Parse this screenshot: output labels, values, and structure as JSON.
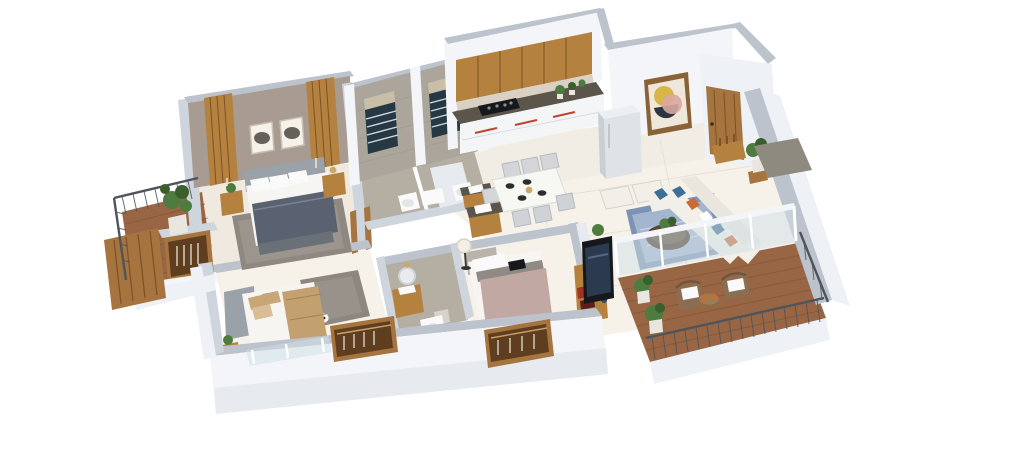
{
  "scene": {
    "title": "3D Isometric Apartment Floor Plan Render",
    "description": "Photorealistic isometric cutaway 3D floor plan of a 3-bedroom apartment on a white background: master bedroom with balcony, two tiled bathrooms, open kitchen with dining, entrance foyer, living room with L-shaped sofa, large wooden terrace, two additional bedrooms with wardrobes and a common bathroom.",
    "background": "#ffffff",
    "view": "isometric-top-down-3d",
    "visible_text": []
  },
  "palette": {
    "bg": "#ffffff",
    "wallCap": "#bcc3cc",
    "wallCapLight": "#cfd5dd",
    "wallFace": "#f3f5f8",
    "wallShade": "#e7ebf0",
    "wallOuter": "#eef1f5",
    "floorCream": "#f2ede4",
    "floorCream2": "#efe9df",
    "floorLight": "#f6f2ea",
    "floorLine": "#e4ddd1",
    "tileWall": "#aba59b",
    "tileWallDark": "#9b958a",
    "bathFloor": "#b4aea3",
    "taupe": "#a89b92",
    "wood": "#a5743f",
    "woodDark": "#7c5226",
    "woodDeck": "#996645",
    "woodDeckDark": "#7a4f33",
    "woodCab": "#b5813f",
    "counterDark": "#5c554b",
    "backsplash": "#d9d1c3",
    "cabinetWhite": "#f4f5f6",
    "handleRed": "#c0432e",
    "fridge": "#dfe3e7",
    "fridgeSide": "#c9ced4",
    "duvetDark": "#5a6170",
    "mattress": "#f6f5f2",
    "headboard": "#9aa1a8",
    "pillowTan": "#c8a678",
    "throwTan": "#c2a070",
    "duvetMauve": "#c2a8a2",
    "rugMaster": "#8f8880",
    "rugBlue": "#7d92b5",
    "rugBlueLight": "#bac7dd",
    "rugBed": "#8e8780",
    "sofa": "#f1efe8",
    "pillowBlue": "#3e6d96",
    "pillowOrange": "#c96b33",
    "tableDark": "#4a372a",
    "rattan": "#8a6e52",
    "green": "#4e7c40",
    "greenDark": "#3a5f2e",
    "potLight": "#e9e6df",
    "rail": "#4f545b",
    "glass": "#cfdfe6",
    "windowFrame": "#253844",
    "louver": "#cfd8da",
    "tv": "#17181b",
    "tvScreen": "#2b3a4e",
    "artYellow": "#d9b545",
    "artPink": "#d8a8a2",
    "artNavy": "#2c3542",
    "artBg": "#efe7da",
    "frameBrown": "#8a6238",
    "doormat": "#8f8a80",
    "lampGold": "#c9a86a",
    "white": "#fafafa"
  },
  "rooms": [
    {
      "id": "master-bedroom",
      "label": "Master Bedroom",
      "furniture": [
        "double bed with dark grey duvet",
        "grey upholstered headboard",
        "white pillows",
        "two nightstands",
        "candle stands",
        "gold table lamp",
        "potted plant",
        "two framed artworks",
        "wood slat accent panels",
        "taupe accent wall",
        "patterned grey rug",
        "wall mounted TV"
      ]
    },
    {
      "id": "master-balcony",
      "label": "Balcony (Master)",
      "furniture": [
        "wooden deck",
        "dark metal railing",
        "potted plant",
        "wood slat privacy screen"
      ]
    },
    {
      "id": "bathroom-1",
      "label": "Bathroom 1",
      "furniture": [
        "stone tiled walls",
        "louvered window",
        "toilet",
        "wash basin"
      ]
    },
    {
      "id": "bathroom-2",
      "label": "Bathroom 2",
      "furniture": [
        "stone tiled walls",
        "louvered window",
        "toilet",
        "wooden vanity with dark counter and sink"
      ]
    },
    {
      "id": "kitchen",
      "label": "Kitchen",
      "furniture": [
        "wooden upper cabinets",
        "stone backsplash",
        "dark countertop",
        "black hob",
        "white base cabinets with red handles",
        "refrigerator",
        "counter plants"
      ]
    },
    {
      "id": "foyer",
      "label": "Entrance Foyer",
      "furniture": [
        "wooden entry door",
        "abstract framed wall art",
        "shoe bench with figurines",
        "potted plant on stool",
        "grey doormat outside"
      ]
    },
    {
      "id": "dining-area",
      "label": "Dining Area",
      "furniture": [
        "white six-seater dining table",
        "upholstered grey chairs",
        "dark place settings",
        "wash basin counter on wooden cabinet"
      ]
    },
    {
      "id": "living-room",
      "label": "Living Room",
      "furniture": [
        "L-shaped cream sofa",
        "blue and orange cushions",
        "round dark wood coffee table with plant",
        "blue patterned rug",
        "two cream ottomans",
        "potted plants",
        "glass partition to terrace"
      ]
    },
    {
      "id": "terrace",
      "label": "Terrace",
      "furniture": [
        "wooden deck",
        "dark metal railing",
        "two rattan chairs with white cushions",
        "round outdoor table with plates",
        "potted plants"
      ]
    },
    {
      "id": "bedroom-2",
      "label": "Bedroom 2",
      "furniture": [
        "bed with tan pillows and throw",
        "grey headboard",
        "grey rug",
        "soccer ball",
        "wall mounted TV",
        "wooden side table with plant",
        "open wooden wardrobe",
        "south window"
      ]
    },
    {
      "id": "common-bathroom",
      "label": "Common Bathroom",
      "furniture": [
        "wooden vanity with round mirror",
        "wall lamp",
        "toilet",
        "grey tile floor"
      ]
    },
    {
      "id": "bedroom-3",
      "label": "Bedroom 3",
      "furniture": [
        "bed with mauve duvet",
        "white pillows",
        "floor lamp with white globe",
        "wall mounted TV on media wall",
        "wooden media console with books and vase",
        "open wooden wardrobe"
      ]
    },
    {
      "id": "wardrobe-niche",
      "label": "Wardrobe Niche",
      "furniture": [
        "open closet with hanging clothes"
      ]
    }
  ]
}
